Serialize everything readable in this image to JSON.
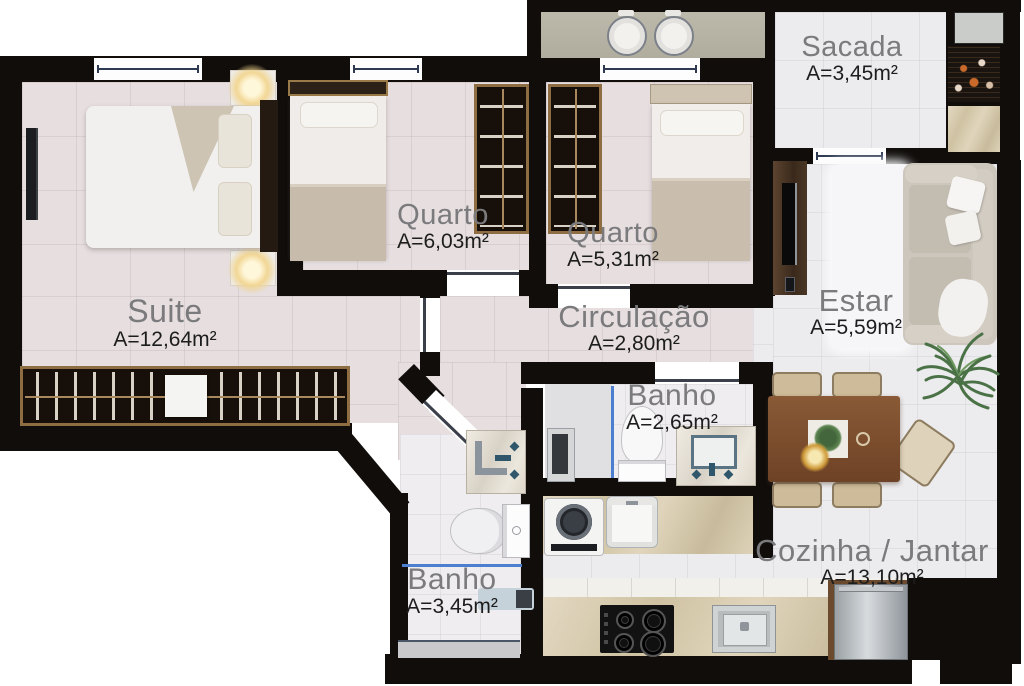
{
  "plan": {
    "title": "apartment-floor-plan",
    "rooms": {
      "sacada": {
        "name": "Sacada",
        "area": "A=3,45m²"
      },
      "quarto1": {
        "name": "Quarto",
        "area": "A=6,03m²"
      },
      "quarto2": {
        "name": "Quarto",
        "area": "A=5,31m²"
      },
      "suite": {
        "name": "Suite",
        "area": "A=12,64m²"
      },
      "circulacao": {
        "name": "Circulação",
        "area": "A=2,80m²"
      },
      "estar": {
        "name": "Estar",
        "area": "A=5,59m²"
      },
      "banho_suite": {
        "name": "Banho",
        "area": "A=2,65m²"
      },
      "banho_social": {
        "name": "Banho",
        "area": "A=3,45m²"
      },
      "cozinha": {
        "name": "Cozinha / Jantar",
        "area": "A=13,10m²"
      }
    },
    "palette": {
      "wall": "#100d0b",
      "floor_warm": "#e6dedf",
      "floor_cool": "#ecebed",
      "counter_marble": "#d2c2a0",
      "laundry_counter": "#b8b5a7",
      "wood_table": "#7d4e2d",
      "wood_panel": "#4b3626",
      "glass_blue": "#4d7fd0",
      "room_name_text": "#7b7b7e",
      "room_area_text": "#1d1d1d",
      "ember_orange": "#c96a2a"
    },
    "furniture_icons": [
      "double-bed",
      "single-bed",
      "wardrobe",
      "nightstand-lamp",
      "tv",
      "sofa",
      "rug",
      "plant",
      "dining-table",
      "chair",
      "pendant-lamp",
      "toilet",
      "bathroom-sink",
      "shower",
      "washing-machine",
      "laundry-sink",
      "cooktop",
      "kitchen-sink",
      "fridge",
      "barbecue-grill",
      "window",
      "door"
    ]
  }
}
